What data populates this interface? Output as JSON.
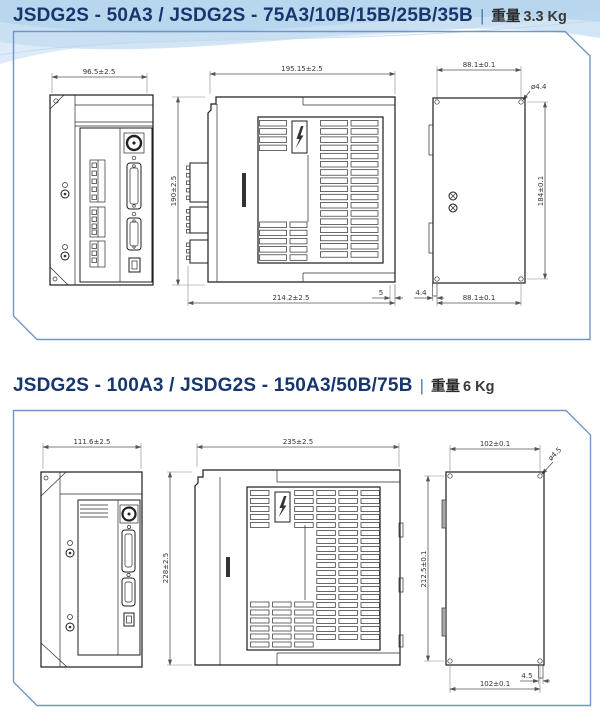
{
  "sections": [
    {
      "title": "JSDG2S - 50A3 / JSDG2S - 75A3/10B/15B/25B/35B",
      "separator": "|",
      "weight_label": "重量",
      "weight_value": "3.3 Kg",
      "dims": {
        "front_width": "96.5±2.5",
        "body_height": "190±2.5",
        "side_top_width": "195.15±2.5",
        "side_bottom_width": "214.2±2.5",
        "side_gap": "5",
        "back_tab": "4.4",
        "back_top_width": "88.1±0.1",
        "back_height": "184±0.1",
        "back_bottom_width": "88.1±0.1",
        "hole_diameter": "ø4.4"
      }
    },
    {
      "title": "JSDG2S - 100A3 / JSDG2S - 150A3/50B/75B",
      "separator": "|",
      "weight_label": "重量",
      "weight_value": "6 Kg",
      "dims": {
        "front_width": "111.6±2.5",
        "body_height": "228±2.5",
        "side_top_width": "235±2.5",
        "back_top_width": "102±0.1",
        "back_height": "212.5±0.1",
        "back_bottom_width": "102±0.1",
        "back_tab": "4.5",
        "hole_diameter": "ø4.5"
      }
    }
  ]
}
